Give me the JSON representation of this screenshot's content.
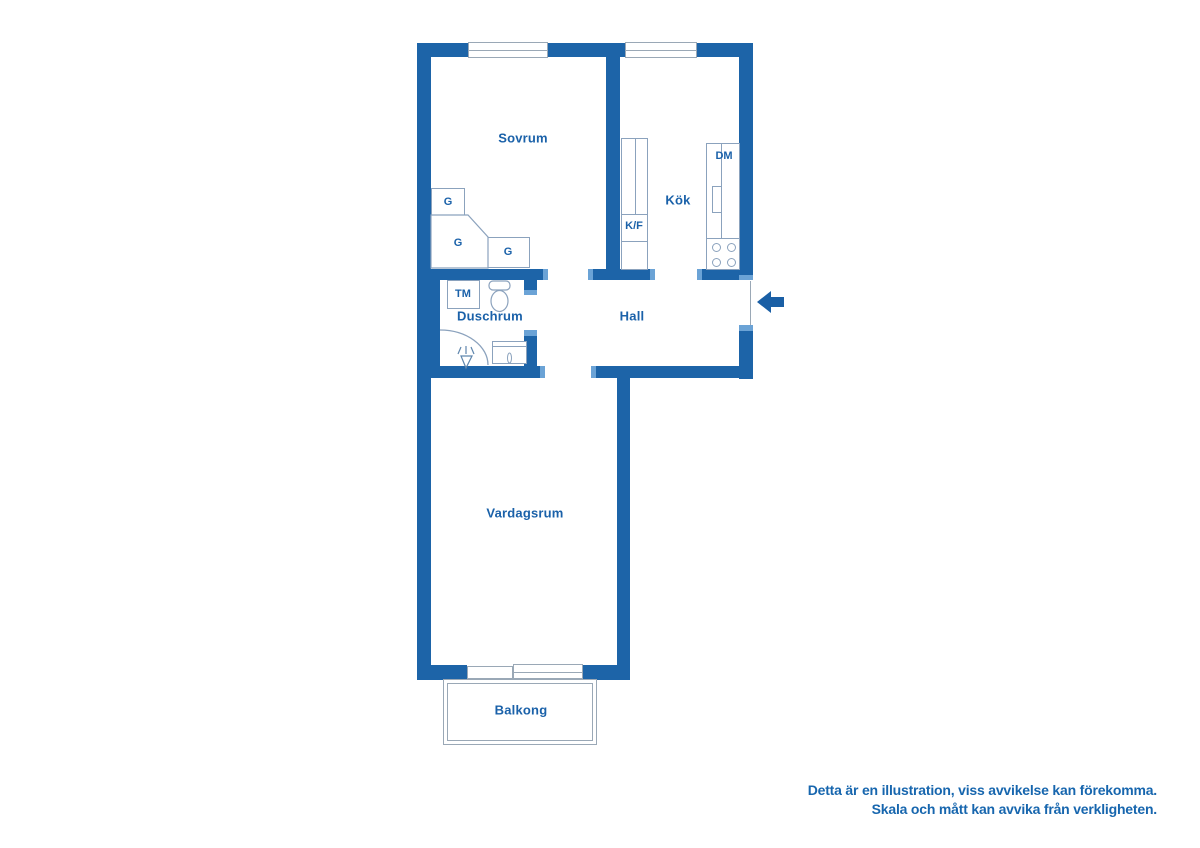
{
  "rooms": {
    "sovrum": "Sovrum",
    "kok": "Kök",
    "hall": "Hall",
    "duschrum": "Duschrum",
    "vardagsrum": "Vardagsrum",
    "balkong": "Balkong"
  },
  "fixtures": {
    "wardrobe": "G",
    "washing_machine": "TM",
    "fridge_freezer": "K/F",
    "dishwasher": "DM"
  },
  "disclaimer": {
    "line1": "Detta är en illustration, viss avvikelse kan förekomma.",
    "line2": "Skala och mått kan avvika från verkligheten."
  },
  "colors": {
    "wall": "#1d64a8",
    "door_jamb": "#6ba3d6",
    "fixture_outline": "#8ba2bd",
    "thin_line": "#9aa8b6",
    "room_label": "#1a61a9",
    "entrance_arrow": "#1a5fa5",
    "disclaimer_text": "#1766ae",
    "background": "#ffffff"
  }
}
